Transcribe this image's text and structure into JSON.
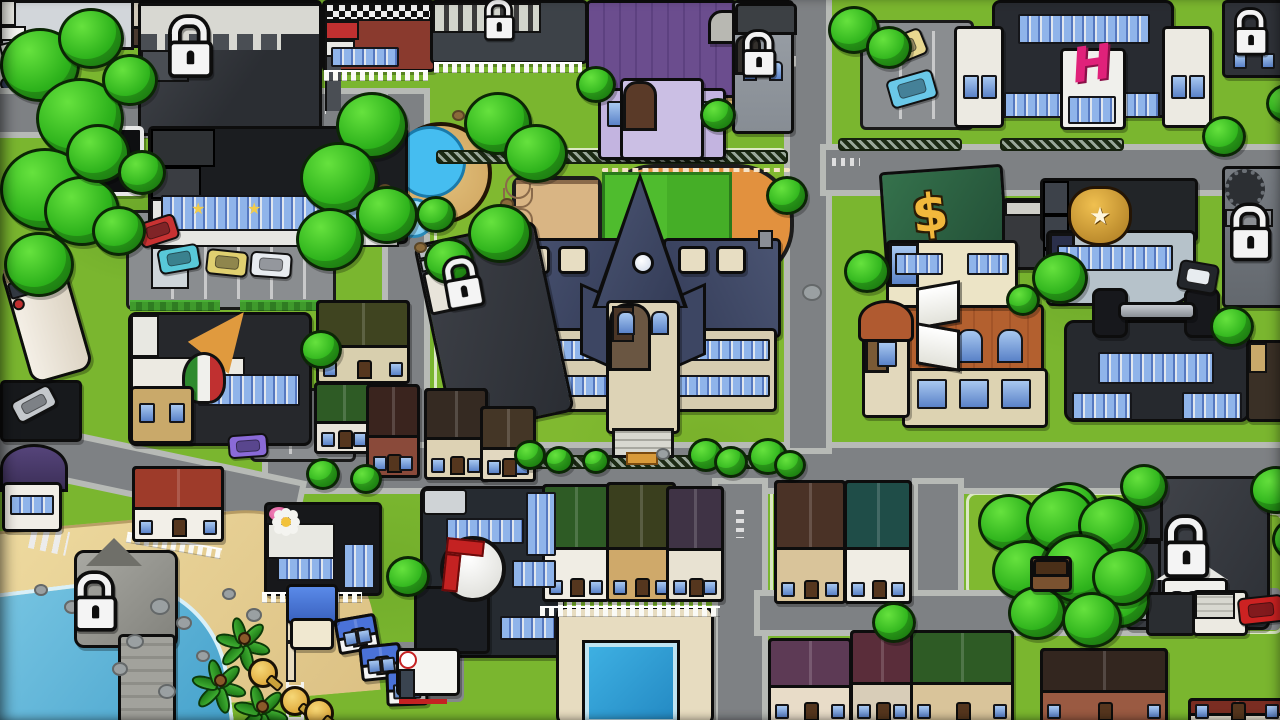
{
  "app": {
    "name": "town-map"
  },
  "icons": {
    "hotel_h": "H",
    "bank_dollar": "$",
    "police_star": "★",
    "store_star": "★"
  },
  "colors": {
    "grass": "#7ab62f",
    "road": "#7e8184",
    "sidewalk": "#b7bab6",
    "water": "#55b3d9",
    "sand": "#e2c98f",
    "outline": "#0d0d0d",
    "lock_white": "#f4f4f4",
    "accent_pink": "#e0217a",
    "gold": "#e8b43a",
    "tree_green": "#2eb31c",
    "rock_gray": "#9aa0a2",
    "dirt_brown": "#8a6a3a"
  },
  "locations": [
    {
      "name": "locked-building-northwest",
      "locked": true
    },
    {
      "name": "department-store",
      "locked": false,
      "icon": "star"
    },
    {
      "name": "store-billboard",
      "locked": false
    },
    {
      "name": "brick-diner",
      "locked": false
    },
    {
      "name": "locked-city-hall",
      "locked": true
    },
    {
      "name": "playground",
      "locked": false
    },
    {
      "name": "purple-dorm-house",
      "locked": false
    },
    {
      "name": "locked-church",
      "locked": true
    },
    {
      "name": "hotel-h-building",
      "locked": false,
      "icon": "hotel_h"
    },
    {
      "name": "north-parking-lot",
      "locked": false
    },
    {
      "name": "locked-tower-northeast",
      "locked": true
    },
    {
      "name": "fountain-plaza",
      "locked": false
    },
    {
      "name": "basketball-court",
      "locked": false
    },
    {
      "name": "running-track",
      "locked": false
    },
    {
      "name": "high-school",
      "locked": false
    },
    {
      "name": "locked-house-by-school",
      "locked": true
    },
    {
      "name": "pizza-parlor",
      "locked": false,
      "icon": "pizza-slice"
    },
    {
      "name": "rv-camper",
      "locked": false
    },
    {
      "name": "carport",
      "locked": false
    },
    {
      "name": "bank",
      "locked": false,
      "icon": "bank_dollar"
    },
    {
      "name": "police-station",
      "locked": false,
      "icon": "police_star"
    },
    {
      "name": "locked-clock-tower-east",
      "locked": true
    },
    {
      "name": "library",
      "locked": false,
      "icon": "open-book"
    },
    {
      "name": "gym",
      "locked": false,
      "icon": "dumbbell"
    },
    {
      "name": "garden-shed",
      "locked": false
    },
    {
      "name": "round-roof-house",
      "locked": false
    },
    {
      "name": "beach",
      "locked": false
    },
    {
      "name": "locked-pier",
      "locked": true
    },
    {
      "name": "lifeguard-tower",
      "locked": false
    },
    {
      "name": "beach-huts",
      "locked": false
    },
    {
      "name": "beach-house",
      "locked": false
    },
    {
      "name": "flower-shop",
      "locked": false,
      "icon": "flower"
    },
    {
      "name": "hospital",
      "locked": false,
      "icon": "red-cross"
    },
    {
      "name": "ambulance",
      "locked": false
    },
    {
      "name": "swimming-pool",
      "locked": false
    },
    {
      "name": "suburban-houses",
      "locked": false
    },
    {
      "name": "treehouse-grove",
      "locked": false
    },
    {
      "name": "locked-mansion",
      "locked": true
    },
    {
      "name": "south-garages",
      "locked": false
    }
  ],
  "scene": {
    "trees": [
      {
        "x": 0,
        "y": 28,
        "s": 74
      },
      {
        "x": 36,
        "y": 78,
        "s": 82
      },
      {
        "x": 0,
        "y": 148,
        "s": 84
      },
      {
        "x": 44,
        "y": 176,
        "s": 70
      },
      {
        "x": 4,
        "y": 232,
        "s": 64
      },
      {
        "x": 66,
        "y": 124,
        "s": 58
      },
      {
        "x": 58,
        "y": 8,
        "s": 60
      },
      {
        "x": 102,
        "y": 54,
        "s": 50
      },
      {
        "x": 92,
        "y": 206,
        "s": 48
      },
      {
        "x": 118,
        "y": 150,
        "s": 42
      },
      {
        "x": 336,
        "y": 92,
        "s": 66
      },
      {
        "x": 300,
        "y": 142,
        "s": 72
      },
      {
        "x": 356,
        "y": 186,
        "s": 56
      },
      {
        "x": 296,
        "y": 208,
        "s": 62
      },
      {
        "x": 464,
        "y": 92,
        "s": 62
      },
      {
        "x": 504,
        "y": 124,
        "s": 58
      },
      {
        "x": 468,
        "y": 204,
        "s": 58
      },
      {
        "x": 424,
        "y": 238,
        "s": 44
      },
      {
        "x": 576,
        "y": 66,
        "s": 34
      },
      {
        "x": 700,
        "y": 98,
        "s": 30
      },
      {
        "x": 766,
        "y": 176,
        "s": 36
      },
      {
        "x": 828,
        "y": 6,
        "s": 46
      },
      {
        "x": 866,
        "y": 26,
        "s": 40
      },
      {
        "x": 1202,
        "y": 116,
        "s": 38
      },
      {
        "x": 1266,
        "y": 84,
        "s": 36
      },
      {
        "x": 416,
        "y": 196,
        "s": 34
      },
      {
        "x": 300,
        "y": 330,
        "s": 36
      },
      {
        "x": 386,
        "y": 556,
        "s": 38
      },
      {
        "x": 1032,
        "y": 252,
        "s": 50
      },
      {
        "x": 1006,
        "y": 284,
        "s": 28
      },
      {
        "x": 1210,
        "y": 306,
        "s": 38
      },
      {
        "x": 844,
        "y": 250,
        "s": 40
      },
      {
        "x": 514,
        "y": 440,
        "s": 26
      },
      {
        "x": 544,
        "y": 446,
        "s": 24
      },
      {
        "x": 582,
        "y": 448,
        "s": 22
      },
      {
        "x": 688,
        "y": 438,
        "s": 30
      },
      {
        "x": 714,
        "y": 446,
        "s": 28
      },
      {
        "x": 748,
        "y": 438,
        "s": 34
      },
      {
        "x": 774,
        "y": 450,
        "s": 26
      },
      {
        "x": 306,
        "y": 458,
        "s": 28
      },
      {
        "x": 350,
        "y": 464,
        "s": 26
      },
      {
        "x": 1038,
        "y": 482,
        "s": 56
      },
      {
        "x": 1082,
        "y": 498,
        "s": 60
      },
      {
        "x": 1044,
        "y": 552,
        "s": 62
      },
      {
        "x": 1090,
        "y": 572,
        "s": 54
      },
      {
        "x": 1120,
        "y": 464,
        "s": 42
      },
      {
        "x": 1250,
        "y": 466,
        "s": 46
      },
      {
        "x": 1272,
        "y": 518,
        "s": 40
      },
      {
        "x": 978,
        "y": 494,
        "s": 56
      },
      {
        "x": 1026,
        "y": 488,
        "s": 64
      },
      {
        "x": 1078,
        "y": 496,
        "s": 58
      },
      {
        "x": 992,
        "y": 540,
        "s": 60
      },
      {
        "x": 1042,
        "y": 534,
        "s": 68,
        "hl": true
      },
      {
        "x": 1092,
        "y": 548,
        "s": 56
      },
      {
        "x": 1008,
        "y": 586,
        "s": 52
      },
      {
        "x": 1062,
        "y": 592,
        "s": 54
      },
      {
        "x": 872,
        "y": 602,
        "s": 38
      }
    ],
    "houses": [
      {
        "n": "tan-house",
        "x": 316,
        "y": 300,
        "w": 88,
        "h": 78,
        "rc": "#3f4420",
        "wc": "#d8cfae"
      },
      {
        "n": "green-roof-house",
        "x": 314,
        "y": 382,
        "w": 54,
        "h": 66,
        "rc": "#2e5b25",
        "wc": "#e8e4da"
      },
      {
        "n": "brick-house",
        "x": 366,
        "y": 384,
        "w": 48,
        "h": 88,
        "rc": "#3a241e",
        "wc": "#8a4a3a"
      },
      {
        "n": "brown-roof-house",
        "x": 424,
        "y": 388,
        "w": 58,
        "h": 86,
        "rc": "#352a22",
        "wc": "#ddd2b4"
      },
      {
        "n": "cream-house",
        "x": 480,
        "y": 406,
        "w": 50,
        "h": 70,
        "rc": "#443626",
        "wc": "#e2d8c0"
      },
      {
        "n": "house-row-1",
        "x": 542,
        "y": 484,
        "w": 62,
        "h": 112,
        "rc": "#2e5b25",
        "wc": "#f0ede4"
      },
      {
        "n": "house-row-2",
        "x": 606,
        "y": 482,
        "w": 64,
        "h": 114,
        "rc": "#3a3f1e",
        "wc": "#cfa96a"
      },
      {
        "n": "house-row-3",
        "x": 666,
        "y": 486,
        "w": 52,
        "h": 110,
        "rc": "#3f3345",
        "wc": "#e8e2d2"
      },
      {
        "n": "house-row-4",
        "x": 774,
        "y": 480,
        "w": 66,
        "h": 118,
        "rc": "#4a3226",
        "wc": "#d9c49a"
      },
      {
        "n": "house-row-5",
        "x": 844,
        "y": 480,
        "w": 62,
        "h": 118,
        "rc": "#1f4d48",
        "wc": "#f0ede4"
      },
      {
        "n": "south-house-1",
        "x": 768,
        "y": 638,
        "w": 78,
        "h": 82,
        "rc": "#5d3a55",
        "wc": "#e8dcc8"
      },
      {
        "n": "south-house-2",
        "x": 850,
        "y": 630,
        "w": 58,
        "h": 90,
        "rc": "#5a2d3a",
        "wc": "#d8cdb8"
      },
      {
        "n": "south-house-3",
        "x": 910,
        "y": 630,
        "w": 98,
        "h": 90,
        "rc": "#2e5b25",
        "wc": "#d9c49a"
      },
      {
        "n": "south-house-4",
        "x": 1040,
        "y": 648,
        "w": 122,
        "h": 72,
        "rc": "#33261f",
        "wc": "#9a5a42"
      },
      {
        "n": "corner-house",
        "x": 1188,
        "y": 698,
        "w": 92,
        "h": 22,
        "rc": "#7a2d22",
        "wc": "#e8e0d0"
      },
      {
        "n": "beach-house",
        "x": 132,
        "y": 466,
        "w": 86,
        "h": 70,
        "rc": "#9e3b2a",
        "wc": "#f2efe8"
      },
      {
        "n": "beach-hut-1",
        "x": 336,
        "y": 616,
        "w": 36,
        "h": 30,
        "rc": "#4a72d8",
        "wc": "#f4f4f4",
        "r": -10
      },
      {
        "n": "beach-hut-2",
        "x": 360,
        "y": 644,
        "w": 36,
        "h": 30,
        "rc": "#4a72d8",
        "wc": "#f4f4f4",
        "r": -6
      },
      {
        "n": "beach-hut-3",
        "x": 386,
        "y": 670,
        "w": 36,
        "h": 30,
        "rc": "#4a72d8",
        "wc": "#f4f4f4",
        "r": -2
      }
    ],
    "cars": [
      {
        "n": "red-car",
        "x": 138,
        "y": 218,
        "w": 36,
        "h": 22,
        "c": "#c83232",
        "r": -18
      },
      {
        "n": "teal-car",
        "x": 158,
        "y": 246,
        "w": 38,
        "h": 22,
        "c": "#58c8d8",
        "r": -10
      },
      {
        "n": "yellow-car",
        "x": 206,
        "y": 250,
        "w": 38,
        "h": 22,
        "c": "#e0d070",
        "r": 6
      },
      {
        "n": "white-car",
        "x": 250,
        "y": 252,
        "w": 38,
        "h": 22,
        "c": "#e8ecf0",
        "r": 4
      },
      {
        "n": "purple-car",
        "x": 228,
        "y": 434,
        "w": 36,
        "h": 20,
        "c": "#8a6ad8",
        "r": -4
      },
      {
        "n": "silver-car",
        "x": 12,
        "y": 392,
        "w": 40,
        "h": 20,
        "c": "#c4c8cc",
        "r": -28
      },
      {
        "n": "yellow-car-north",
        "x": 880,
        "y": 34,
        "w": 42,
        "h": 24,
        "c": "#e8d890",
        "r": -22
      },
      {
        "n": "blue-car-north",
        "x": 888,
        "y": 74,
        "w": 44,
        "h": 26,
        "c": "#6ac8e8",
        "r": -16
      },
      {
        "n": "police-car",
        "x": 1178,
        "y": 262,
        "w": 36,
        "h": 26,
        "c": "#23262b",
        "r": 10,
        "police": true
      },
      {
        "n": "red-sports-car",
        "x": 1238,
        "y": 596,
        "w": 42,
        "h": 24,
        "c": "#cc2222",
        "r": -6
      }
    ],
    "locks": [
      {
        "x": 168,
        "y": 18,
        "s": 1.25
      },
      {
        "x": 484,
        "y": 0,
        "s": 0.85
      },
      {
        "x": 742,
        "y": 32,
        "s": 0.95
      },
      {
        "x": 1234,
        "y": 10,
        "s": 0.95
      },
      {
        "x": 1230,
        "y": 206,
        "s": 1.15
      },
      {
        "x": 440,
        "y": 262,
        "s": 1.05,
        "r": -10
      },
      {
        "x": 74,
        "y": 574,
        "s": 1.2
      },
      {
        "x": 1164,
        "y": 518,
        "s": 1.25
      }
    ],
    "collectibles": [
      {
        "x": 248,
        "y": 658
      },
      {
        "x": 280,
        "y": 686
      },
      {
        "x": 304,
        "y": 698
      }
    ],
    "palms": [
      {
        "x": 244,
        "y": 638
      },
      {
        "x": 220,
        "y": 680
      },
      {
        "x": 262,
        "y": 706
      }
    ],
    "dots": [
      {
        "x": 150,
        "y": 598,
        "s": 16,
        "t": "rock"
      },
      {
        "x": 176,
        "y": 616,
        "s": 12,
        "t": "rock"
      },
      {
        "x": 126,
        "y": 634,
        "s": 14,
        "t": "rock"
      },
      {
        "x": 196,
        "y": 650,
        "s": 10,
        "t": "rock"
      },
      {
        "x": 112,
        "y": 662,
        "s": 12,
        "t": "rock"
      },
      {
        "x": 158,
        "y": 684,
        "s": 14,
        "t": "rock"
      },
      {
        "x": 222,
        "y": 588,
        "s": 10,
        "t": "rock"
      },
      {
        "x": 246,
        "y": 608,
        "s": 12,
        "t": "rock"
      },
      {
        "x": 64,
        "y": 600,
        "s": 12,
        "t": "rock"
      },
      {
        "x": 34,
        "y": 584,
        "s": 10,
        "t": "rock"
      },
      {
        "x": 802,
        "y": 284,
        "s": 16,
        "t": "rock"
      },
      {
        "x": 656,
        "y": 448,
        "s": 10,
        "t": "rock"
      },
      {
        "x": 378,
        "y": 184,
        "s": 10,
        "t": "dirt"
      },
      {
        "x": 452,
        "y": 110,
        "s": 9,
        "t": "dirt"
      },
      {
        "x": 500,
        "y": 198,
        "s": 10,
        "t": "dirt"
      },
      {
        "x": 414,
        "y": 242,
        "s": 9,
        "t": "dirt"
      }
    ]
  }
}
